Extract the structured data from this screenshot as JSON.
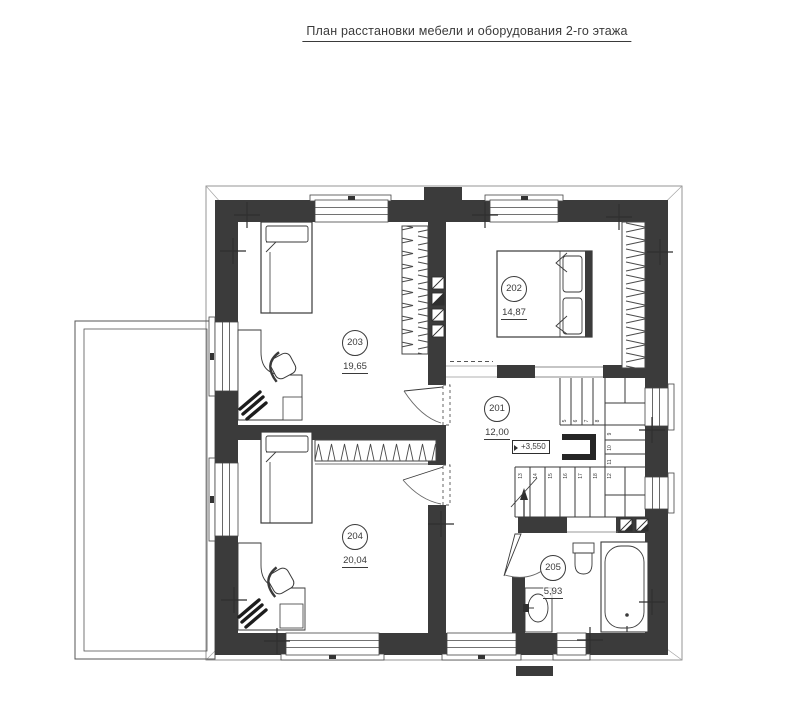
{
  "title": "План расстановки мебели и оборудования 2-го этажа",
  "rooms": {
    "r201": {
      "number": "201",
      "area": "12,00"
    },
    "r202": {
      "number": "202",
      "area": "14,87"
    },
    "r203": {
      "number": "203",
      "area": "19,65"
    },
    "r204": {
      "number": "204",
      "area": "20,04"
    },
    "r205": {
      "number": "205",
      "area": "5,93"
    }
  },
  "elevation": {
    "value": "+3,550"
  },
  "stairs": {
    "steps": [
      "5",
      "6",
      "7",
      "8",
      "9",
      "10",
      "11",
      "12",
      "13",
      "14",
      "15",
      "16",
      "17",
      "18"
    ]
  },
  "colors": {
    "wall": "#3b3b3b",
    "line": "#3a3a3a",
    "thin": "#777777"
  }
}
